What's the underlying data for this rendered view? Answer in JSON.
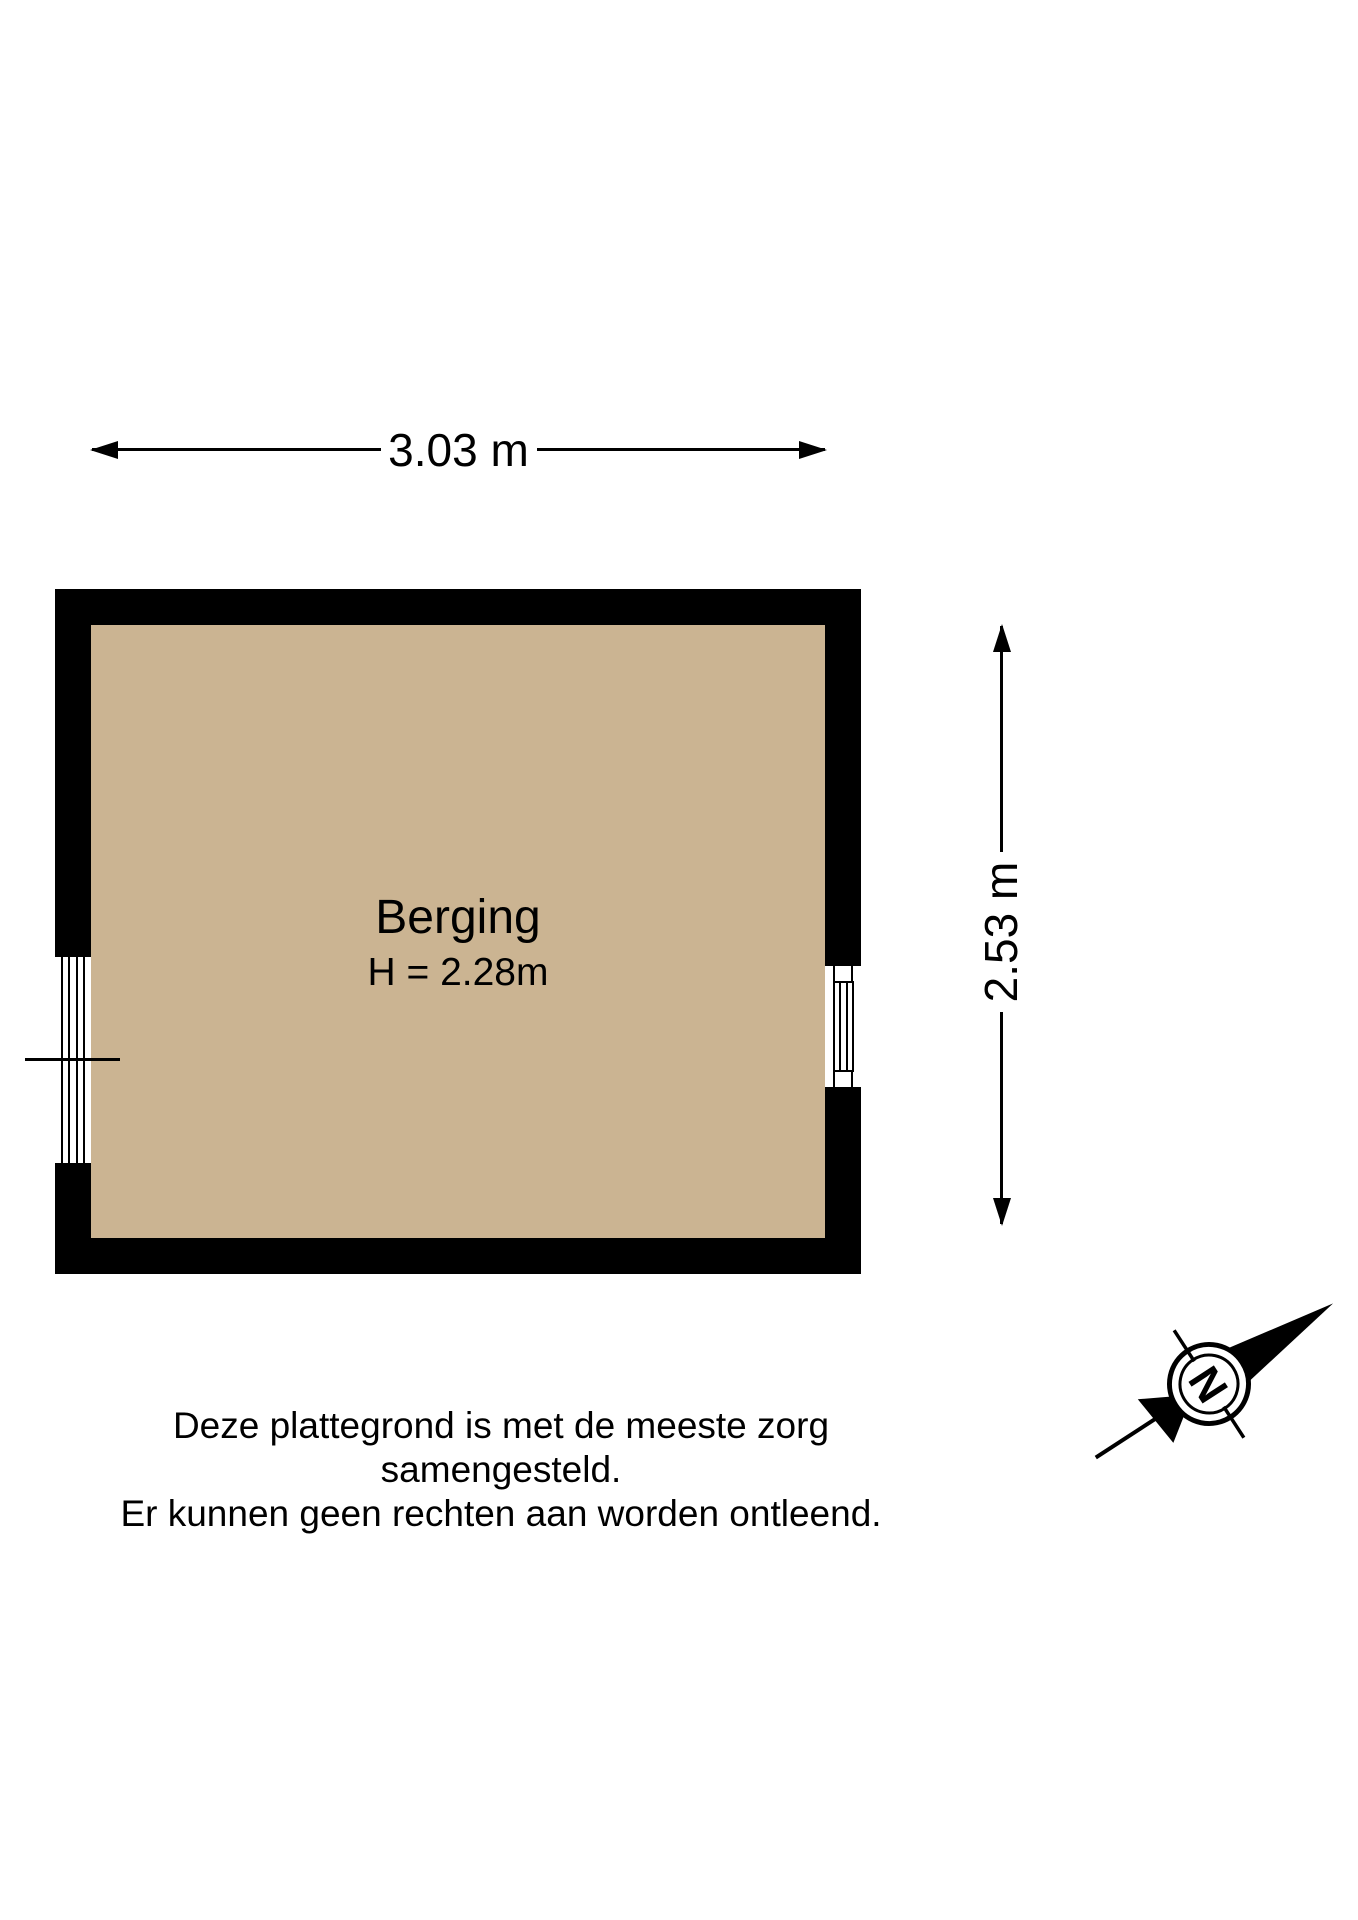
{
  "floorplan": {
    "room": {
      "name": "Berging",
      "height_label": "H = 2.28m"
    },
    "dimensions": {
      "width": "3.03 m",
      "height": "2.53 m"
    },
    "colors": {
      "wall": "#000000",
      "floor": "#cbb492",
      "line": "#000000",
      "background": "#ffffff"
    }
  },
  "compass": {
    "north_label": "N"
  },
  "disclaimer": {
    "line1": "Deze plattegrond is met de meeste zorg samengesteld.",
    "line2": "Er kunnen geen rechten aan worden ontleend."
  }
}
